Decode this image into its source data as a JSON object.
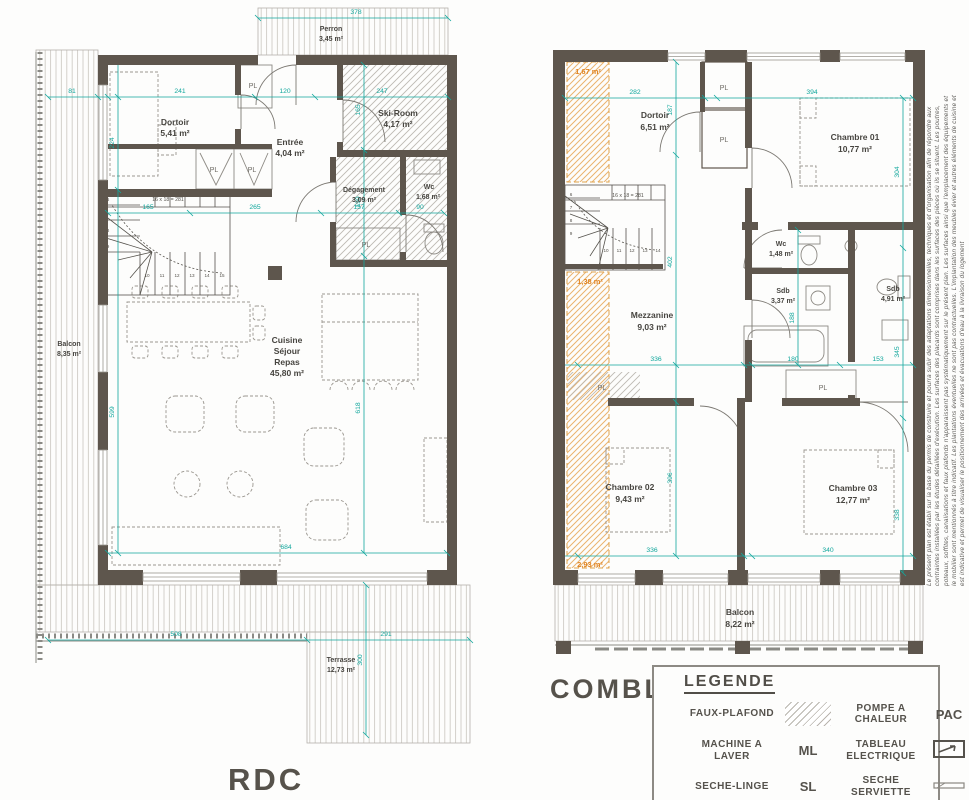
{
  "titles": {
    "rdc": "RDC",
    "combles": "COMBLES"
  },
  "shared": {
    "pl": "PL",
    "stair_note": "16 x 18 = 281",
    "steps": [
      "6",
      "7",
      "8",
      "9",
      "10",
      "11",
      "12",
      "13",
      "14",
      "15"
    ]
  },
  "rdc": {
    "perron": [
      "Perron",
      "3,45 m²"
    ],
    "dortoir": [
      "Dortoir",
      "5,41 m²"
    ],
    "entree": [
      "Entrée",
      "4,04 m²"
    ],
    "skiroom": [
      "Ski-Room",
      "4,17 m²"
    ],
    "degagement": [
      "Dégagement",
      "3,09 m²"
    ],
    "wc": [
      "Wc",
      "1,68 m²"
    ],
    "cuisine": [
      "Cuisine",
      "Séjour",
      "Repas",
      "45,80 m²"
    ],
    "balcon": [
      "Balcon",
      "8,35 m²"
    ],
    "terrasse": [
      "Terrasse",
      "12,73 m²"
    ],
    "dims": {
      "d378": "378",
      "d81": "81",
      "d241": "241",
      "d120": "120",
      "d247": "247",
      "d224": "224",
      "d165a": "165",
      "d199": "199",
      "d165b": "165",
      "d265": "265",
      "d157": "157",
      "d90": "90",
      "d599": "599",
      "d618": "618",
      "d684": "684",
      "d508": "508",
      "d291": "291",
      "d300": "300"
    }
  },
  "combles": {
    "dortoir": [
      "Dortoir",
      "6,51 m²"
    ],
    "chambre01": [
      "Chambre 01",
      "10,77 m²"
    ],
    "wc": [
      "Wc",
      "1,48 m²"
    ],
    "sdb1": [
      "Sdb",
      "3,37 m²"
    ],
    "sdb2": [
      "Sdb",
      "4,91 m²"
    ],
    "mezzanine": [
      "Mezzanine",
      "9,03 m²"
    ],
    "chambre02": [
      "Chambre 02",
      "9,43 m²"
    ],
    "chambre03": [
      "Chambre 03",
      "12,77 m²"
    ],
    "balcon": [
      "Balcon",
      "8,22 m²"
    ],
    "orange": [
      "1,67 m²",
      "1,38 m²",
      "2,93 m²"
    ],
    "dims": {
      "d282": "282",
      "d187": "187",
      "d394": "394",
      "d304": "304",
      "d402": "402",
      "d188": "188",
      "d336a": "336",
      "d180": "180",
      "d153": "153",
      "d345": "345",
      "d396": "396",
      "d336b": "336",
      "d340": "340",
      "d338": "338"
    }
  },
  "legend": {
    "title": "LEGENDE",
    "items": [
      {
        "label": "FAUX-PLAFOND",
        "symbol_text": ""
      },
      {
        "label": "POMPE A CHALEUR",
        "symbol_text": "PAC"
      },
      {
        "label": "MACHINE A LAVER",
        "symbol_text": "ML"
      },
      {
        "label": "TABLEAU ELECTRIQUE",
        "symbol_text": ""
      },
      {
        "label": "SECHE-LINGE",
        "symbol_text": "SL"
      },
      {
        "label": "SECHE SERVIETTE",
        "symbol_text": ""
      },
      {
        "label": "BALLON EAU",
        "symbol_text": ""
      }
    ]
  },
  "disclaimer": [
    "Le présent plan est établi sur la base du permis de construire et pourra subir des adaptations dimensionnelles, techniques et d'organisation afin de répondre aux",
    "contraintes installées par les études détaillées d'exécution. Les surfaces des placards sont comprises dans les surfaces des pièces où ils se situent. Les poutres,",
    "poteaux, soffites, canalisations et faux plafonds n'apparaissent pas systématiquement sur le présent plan. Les surfaces ainsi que l'emplacement des équipements et",
    "le mobilier sont mentionnés à titre indicatif. Les plantations éventuelles ne sont pas contractuelles. L'implantation des meubles évier et autres éléments de cuisine et",
    "est indicative et permet de visualiser le positionnement des arrivées et évacuations d'eau à la livraison du logement"
  ],
  "colors": {
    "wall": "#5e564d",
    "dimension": "#12a79d",
    "orange": "#e0831f"
  }
}
